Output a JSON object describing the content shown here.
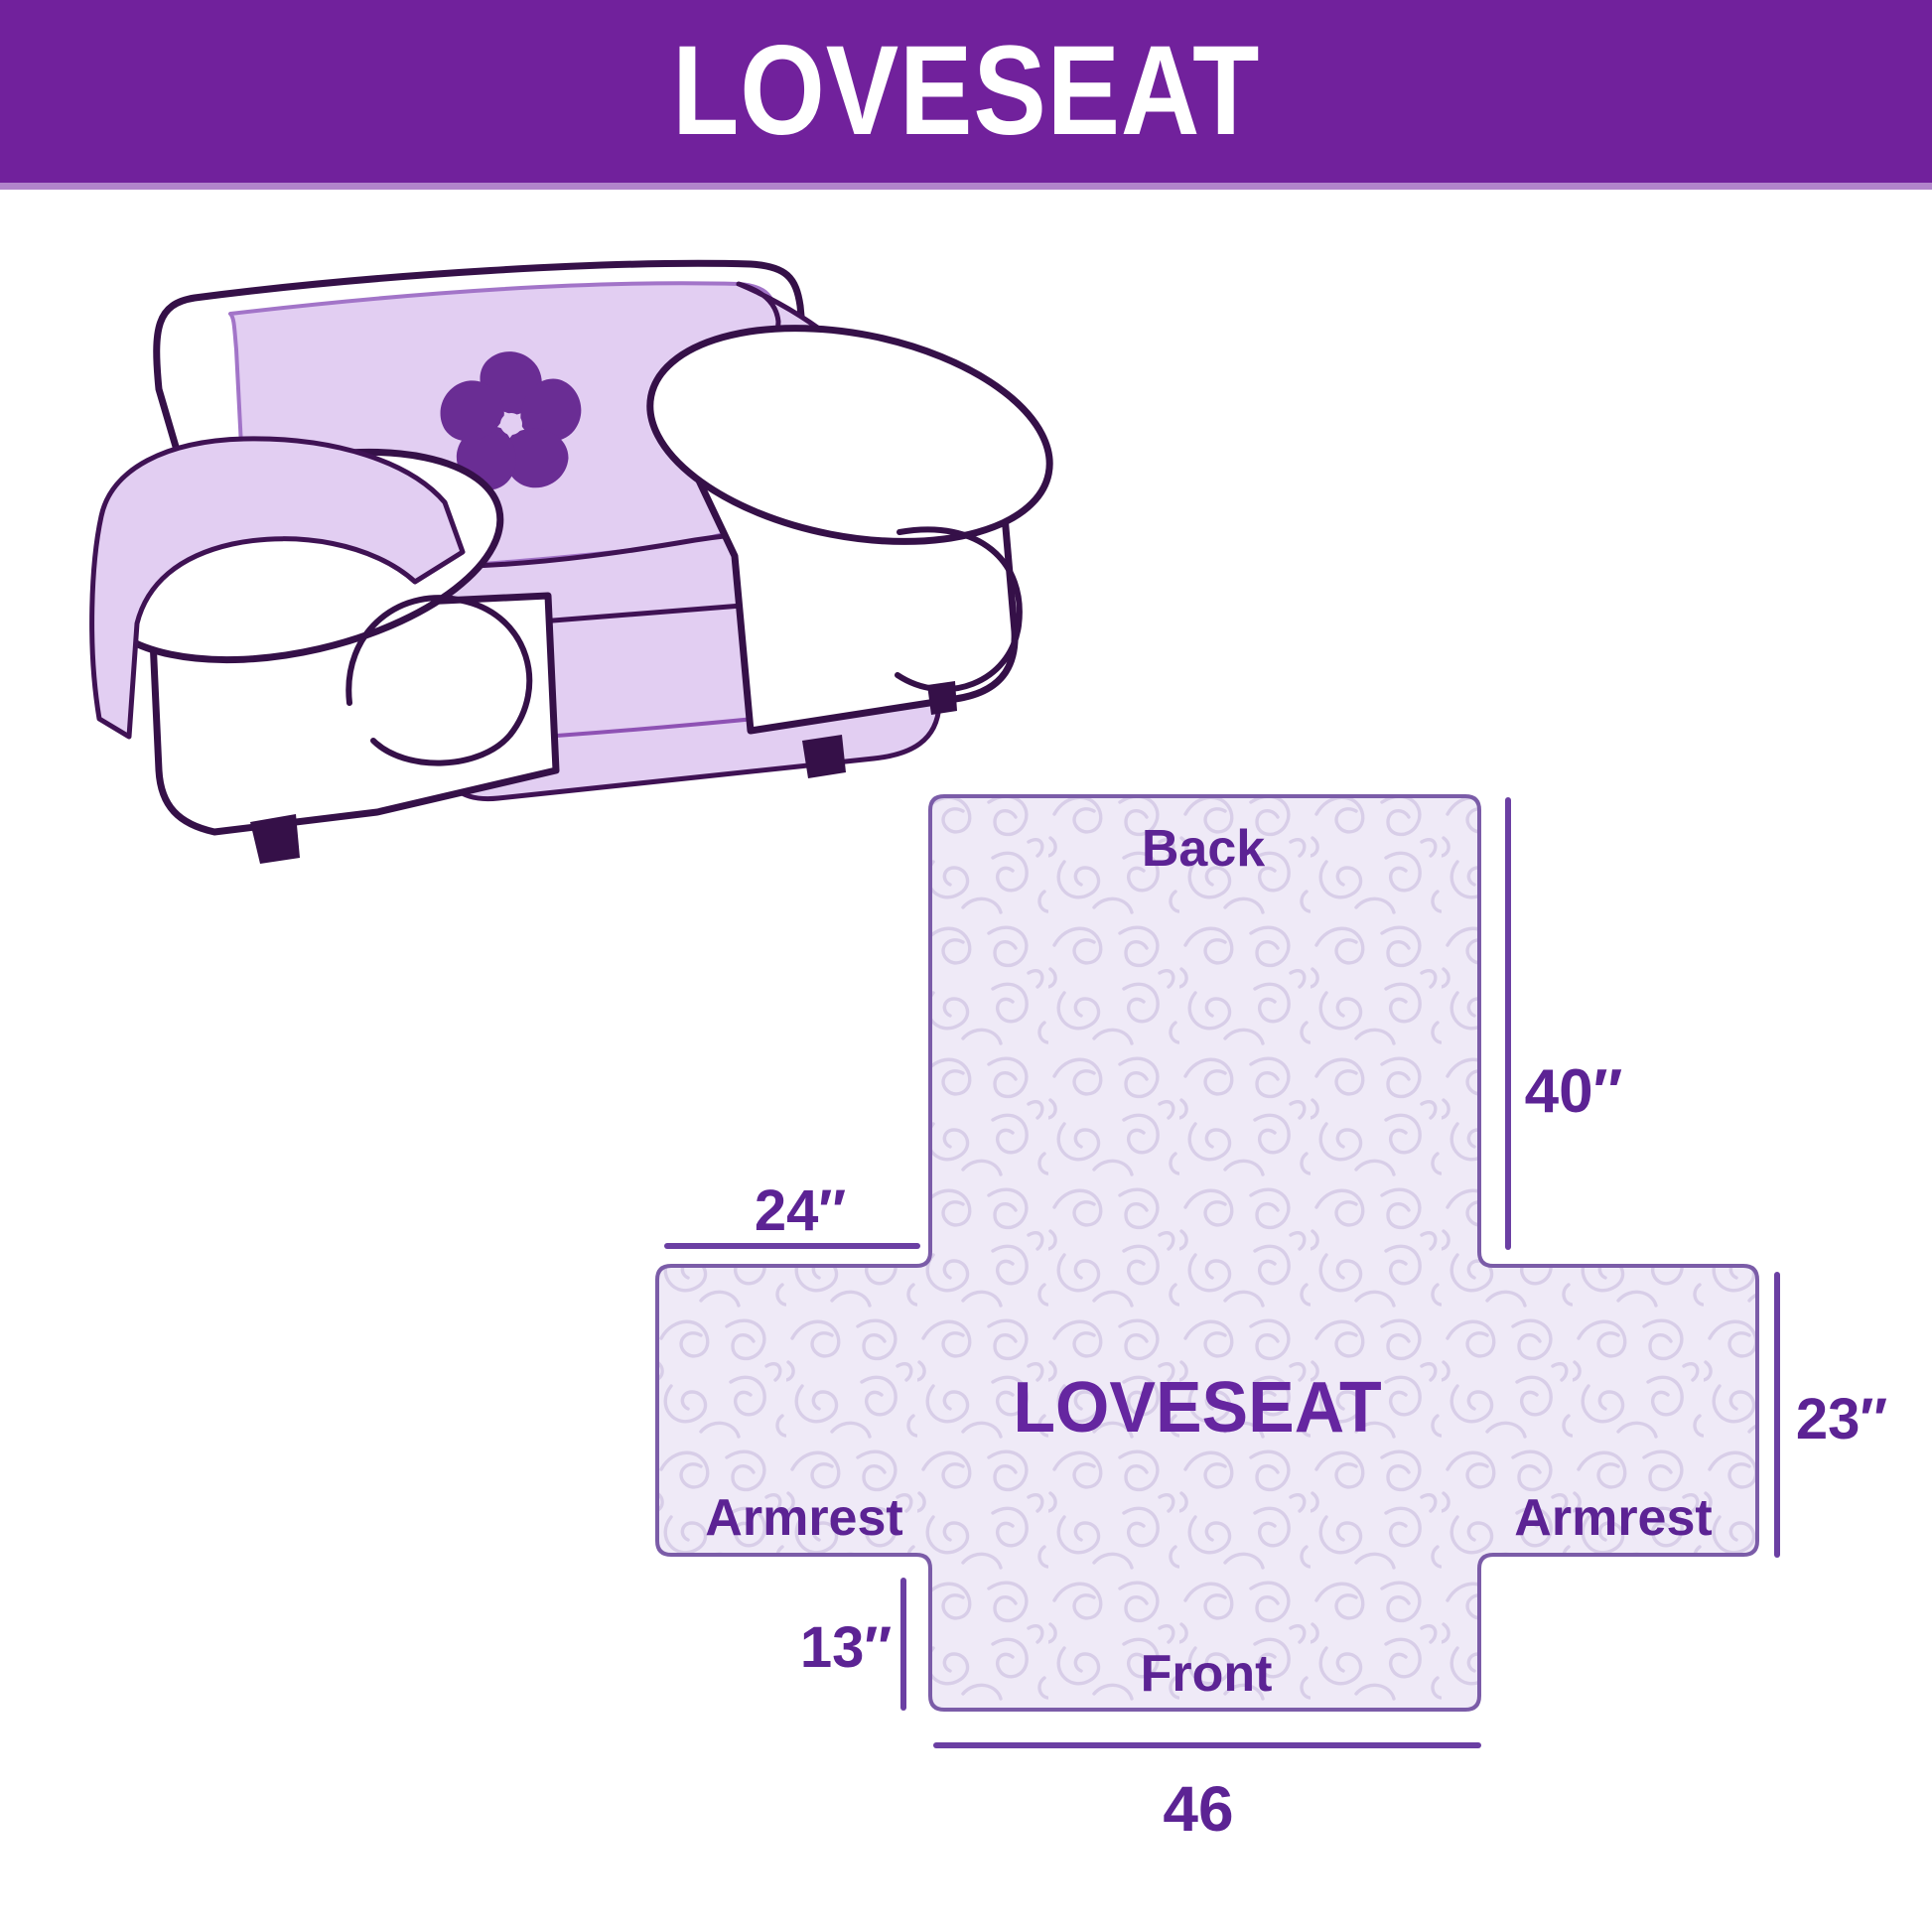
{
  "header": {
    "title": "LOVESEAT",
    "bg_color": "#71219C",
    "underline_color": "#B184CB",
    "text_color": "#FFFFFF"
  },
  "illustration": {
    "subject": "loveseat sofa with protective slipcover",
    "cover_color": "#E2CEF2",
    "outline_color": "#351048",
    "logo": "pinwheel",
    "logo_color": "#6A2D94"
  },
  "diagram": {
    "type": "dimension-diagram",
    "center_label": "LOVESEAT",
    "panel_labels": {
      "back": "Back",
      "armrest_left": "Armrest",
      "armrest_right": "Armrest",
      "front": "Front"
    },
    "dimensions": {
      "back_height": "40″",
      "armrest_width": "24″",
      "side_height": "23″",
      "front_height": "13″",
      "front_width": "46"
    },
    "fill_color": "#EFEAF7",
    "pattern_color": "#D8CEE8",
    "border_color": "#7B5CA8",
    "label_color": "#5C2394",
    "line_color": "#6B3FA3"
  }
}
